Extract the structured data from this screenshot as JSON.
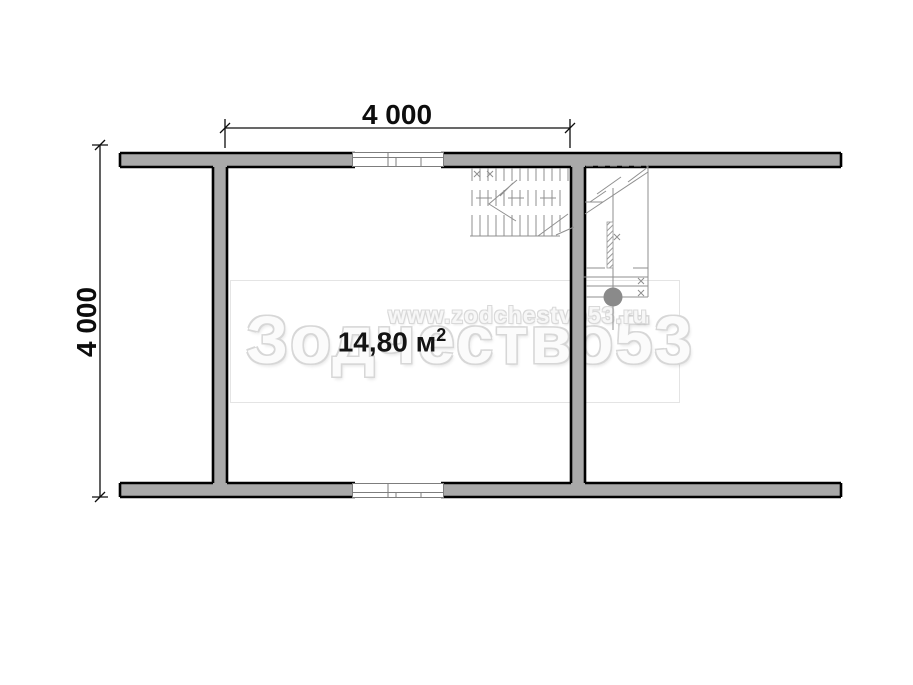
{
  "plan": {
    "dimension_top_label": "4 000",
    "dimension_left_label": "4 000",
    "room_area_value": "14,80",
    "room_area_unit": "м",
    "room_area_exponent": "2"
  },
  "watermark": {
    "url": "www.zodchestvo53.ru",
    "brand": "Зодчество53"
  },
  "colors": {
    "wall_fill": "#A9A9A9",
    "wall_outline": "#000000",
    "detail_line": "#8F8F8F",
    "watermark_gray": "#D7D7D7",
    "dimension_text": "#0D0D0D",
    "marker_circle": "#8A8A8A"
  }
}
